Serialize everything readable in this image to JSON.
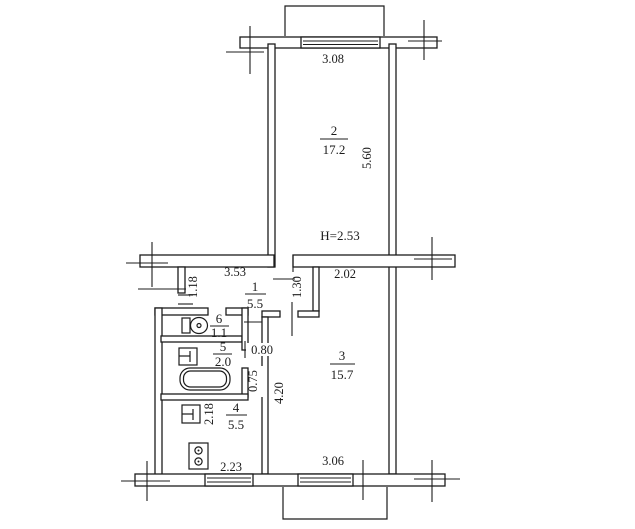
{
  "plan": {
    "type": "apartment-floor-plan",
    "ceiling_height_label": "H=2.53",
    "rooms": [
      {
        "id": "room-1-hall",
        "number": "1",
        "area": "5.5"
      },
      {
        "id": "room-2-living",
        "number": "2",
        "area": "17.2"
      },
      {
        "id": "room-3-living",
        "number": "3",
        "area": "15.7"
      },
      {
        "id": "room-4-kitchen",
        "number": "4",
        "area": "5.5"
      },
      {
        "id": "room-5-bath",
        "number": "5",
        "area": "2.0"
      },
      {
        "id": "room-6-wc",
        "number": "6",
        "area": "1.1"
      }
    ],
    "dimensions": {
      "top_window_width": "3.08",
      "room2_depth": "5.60",
      "hall_width": "3.53",
      "room3_upper_width": "2.02",
      "hall_depth": "1.18",
      "room1_nook_depth": "1.30",
      "corridor_width": "0.80",
      "corridor_depth": "0.75",
      "room3_depth": "4.20",
      "kitchen_depth": "2.18",
      "kitchen_window_width": "2.23",
      "room3_window_width": "3.06"
    },
    "icons": {
      "toilet": "toilet-icon",
      "washbasin": "washbasin-icon",
      "bathtub": "bathtub-icon",
      "kitchen_sink": "kitchen-sink-icon",
      "stove": "stove-icon"
    },
    "colors": {
      "line": "#1c1c1c",
      "background": "#ffffff"
    }
  }
}
